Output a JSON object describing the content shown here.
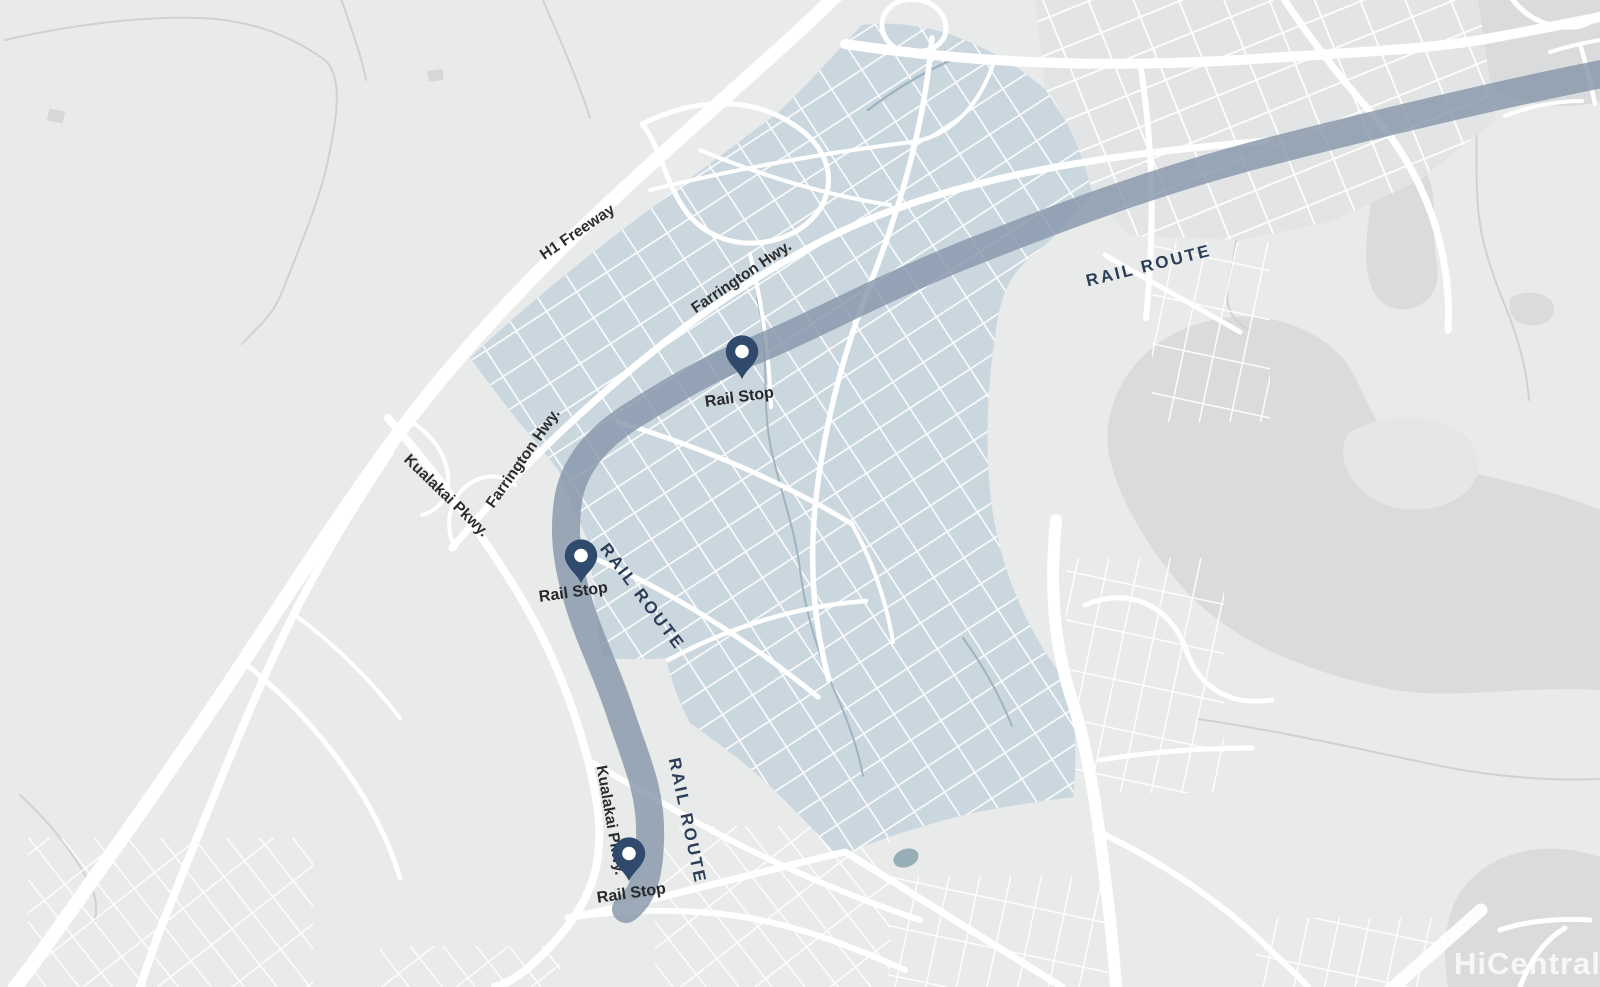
{
  "map": {
    "description": "Static area map with rail route and rail stops",
    "road_labels": {
      "h1_freeway": "H1 Freeway",
      "farrington_hwy": "Farrington Hwy.",
      "kualakai_pkwy": "Kualakai Pkwy."
    },
    "rail": {
      "route_label": "RAIL ROUTE",
      "stop_label": "Rail Stop",
      "route_label_count": 3,
      "stop_count": 3
    },
    "watermark": "HiCentralMLS",
    "colors": {
      "background": "#e9eaea",
      "terrain": "#dadbdc",
      "urban_block": "#e3e4e5",
      "highlight_area": "#cbd7df",
      "rail_route_line": "#8495a9",
      "road": "#ffffff",
      "pin": "#2f4a6c",
      "rail_route_text": "#2c3e57",
      "road_label_text": "#2b2c2e",
      "stream": "#9eb4c0",
      "trail": "#d1d1d1"
    }
  }
}
